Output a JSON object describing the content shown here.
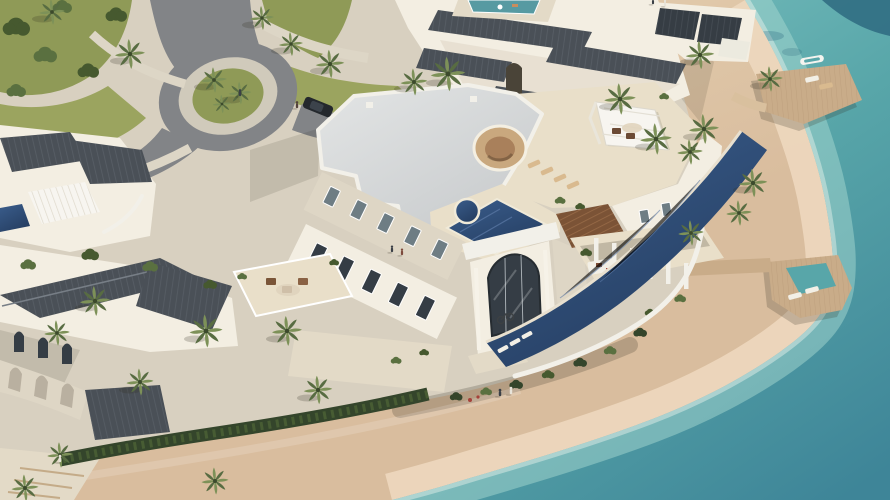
{
  "meta": {
    "scene": "Aerial 3D architectural rendering of a luxury beachfront villa community on a turquoise lagoon",
    "view": "high-angle aerial view, sunlight from the upper right, shoreline running diagonally from top to lower left",
    "canvas": {
      "width": 890,
      "height": 500
    }
  },
  "palette": {
    "sea_deep": "#3e8598",
    "sea_mid": "#58a6a9",
    "sea_shallow": "#79bfbe",
    "sea_dark": "#2e6a80",
    "shallow_band": "#a5d8d0",
    "foam": "#ecf5ee",
    "sand_dry": "#d9bd9e",
    "sand_light": "#e9d6b8",
    "sand_wet": "#eed9bf",
    "paving": "#d8d0c0",
    "paving_light": "#e3dac7",
    "road": "#828487",
    "road_ring": "#d0cabb",
    "grass": "#8f9a57",
    "grass2": "#9ba45f",
    "tree_dark": "#46592f",
    "tree_mid": "#5a7040",
    "palm_light": "#7d9158",
    "palm_dark": "#586c42",
    "hedge": "#34452b",
    "roof_gray": "#4a5057",
    "roof_rib": "#646b73",
    "panel_dark": "#363d44",
    "roof_white_a": "#e3e5e5",
    "roof_white_b": "#c7cacc",
    "parapet": "#f2f0e9",
    "wall_light": "#f3eee2",
    "wall_shade": "#ded6c5",
    "deck_cream": "#e9dfc9",
    "window": "#6e7d84",
    "glass_dark": "#353d45",
    "pool_light": "#3a5d8c",
    "pool_dark": "#263f63",
    "pool_teal": "#579aa2",
    "wood_brown": "#7b5336",
    "wood_slat": "#a0714c",
    "pier_wood": "#c9ac89",
    "plank": "#b69876",
    "canopy": "#f7f5f0",
    "tan_circle": "#c9a87e",
    "tan_inner": "#a9805b",
    "car_body": "#24282d",
    "accent_red": "#a5423a",
    "lounger_tan": "#d9ba8f",
    "lounger_white": "#f2efe6"
  },
  "inventory": {
    "buildings": [
      "main beachfront villa with stepped white terraces",
      "neighboring villa with dark tiled ridge roofs (top)",
      "villa with dark hip roofs and arched arcade (lower left)",
      "villa with pergola and plunge pool (upper left)",
      "penthouse block with dark roof panels (top right)"
    ],
    "water_features": [
      "turquoise lagoon",
      "ground-level infinity lap pool",
      "rooftop tiled pool with round spa",
      "rooftop circular lounge bowl",
      "neighbor rooftop pool"
    ],
    "landscape": [
      "curved sandy beach",
      "palm trees",
      "hedgerows and shrubs",
      "olive-green lawns",
      "asphalt road with palm roundabout",
      "paved promenade with steps"
    ],
    "objects": [
      "two wooden sun decks over the water",
      "white kayak",
      "sun loungers",
      "white shade canopy",
      "brown slatted pergola",
      "glass arch atrium",
      "satellite dish",
      "bicycle",
      "parked car",
      "people walking"
    ],
    "counts": {
      "palm_trees": 28,
      "people": 9,
      "sun_decks": 2,
      "visible_pools": 5,
      "parked_cars": 1,
      "kayaks": 1
    }
  }
}
